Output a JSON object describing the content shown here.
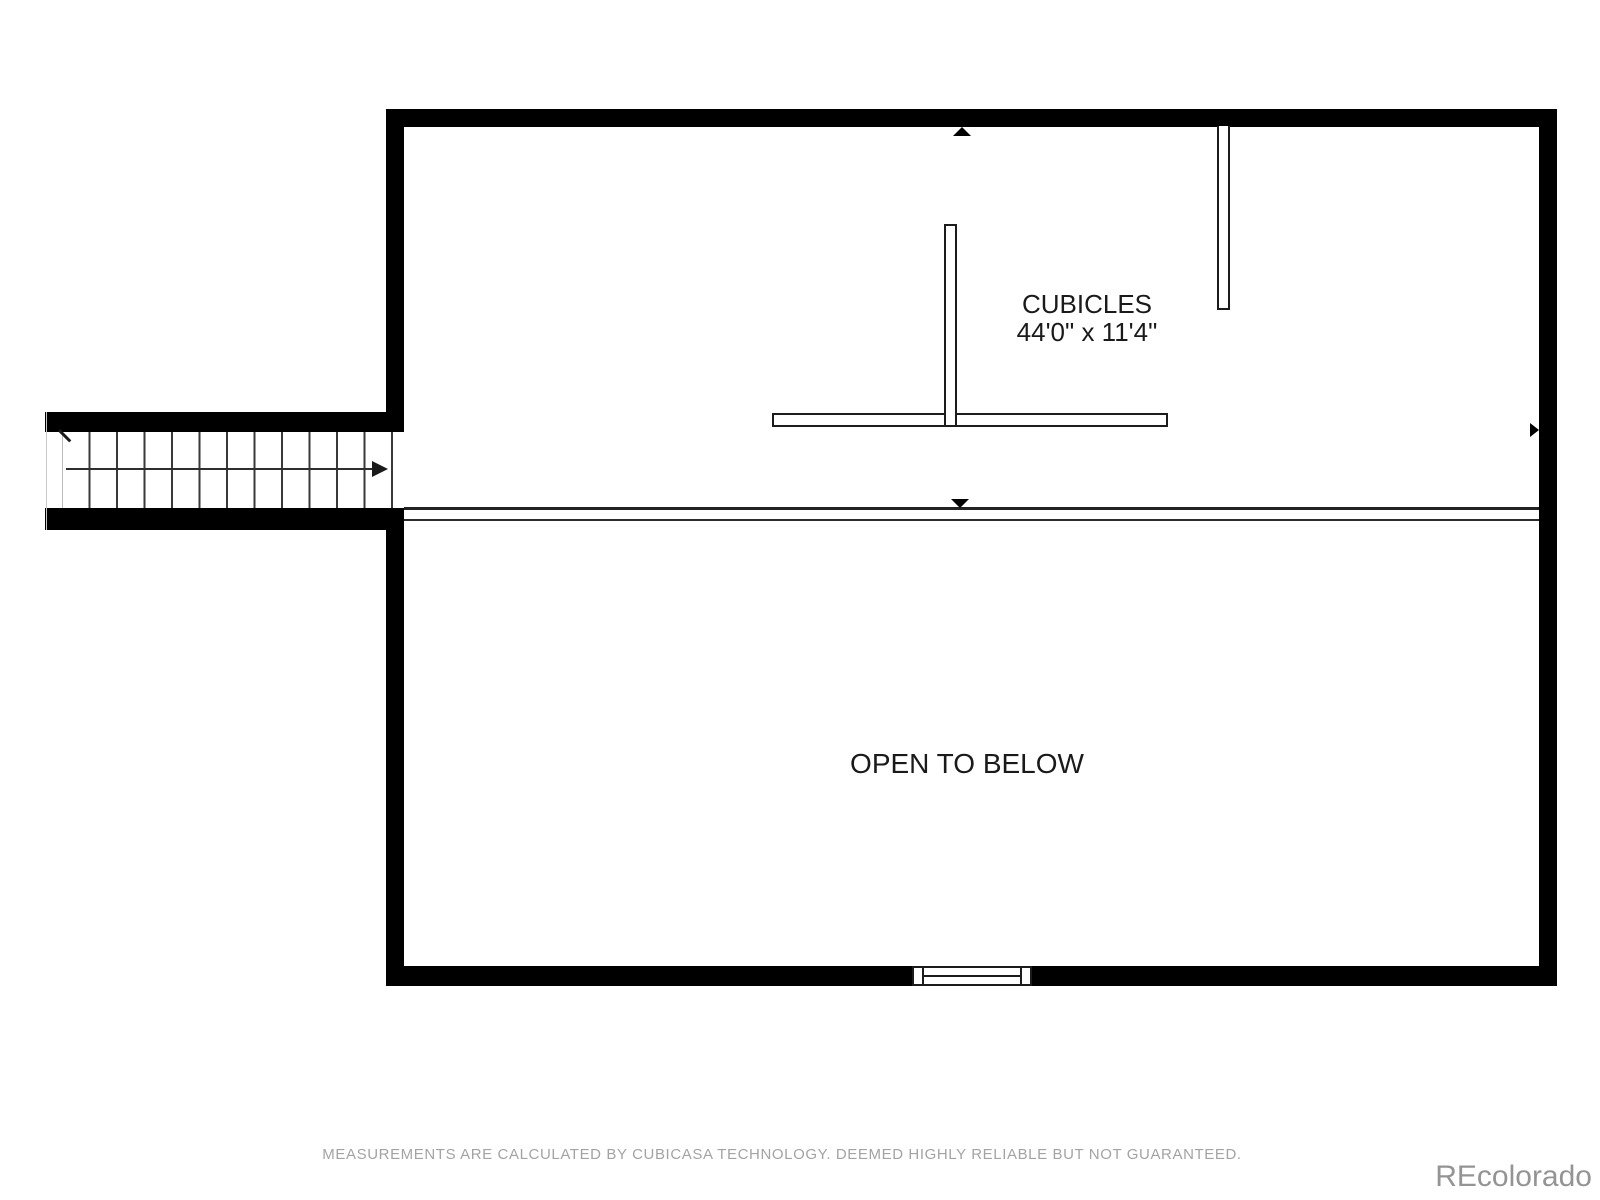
{
  "plan": {
    "room_label": {
      "name": "CUBICLES",
      "dimensions": "44'0\" x 11'4\""
    },
    "open_area_label": "OPEN TO BELOW",
    "stairs": {
      "tread_count": 12,
      "direction": "right"
    },
    "markers": [
      "up-triangle-top-wall",
      "down-triangle-mezzanine-edge",
      "right-triangle-right-wall"
    ],
    "features": [
      "staircase",
      "mezzanine-edge",
      "window-bottom-wall",
      "partition-walls"
    ]
  },
  "footer": {
    "disclaimer": "MEASUREMENTS ARE CALCULATED BY CUBICASA TECHNOLOGY. DEEMED HIGHLY RELIABLE BUT NOT GUARANTEED.",
    "watermark": "REcolorado"
  },
  "colors": {
    "wall": "#000000",
    "line": "#2c2c2c",
    "label_text": "#1a1a1a",
    "muted_text": "#a3a3a3",
    "background": "#ffffff"
  }
}
